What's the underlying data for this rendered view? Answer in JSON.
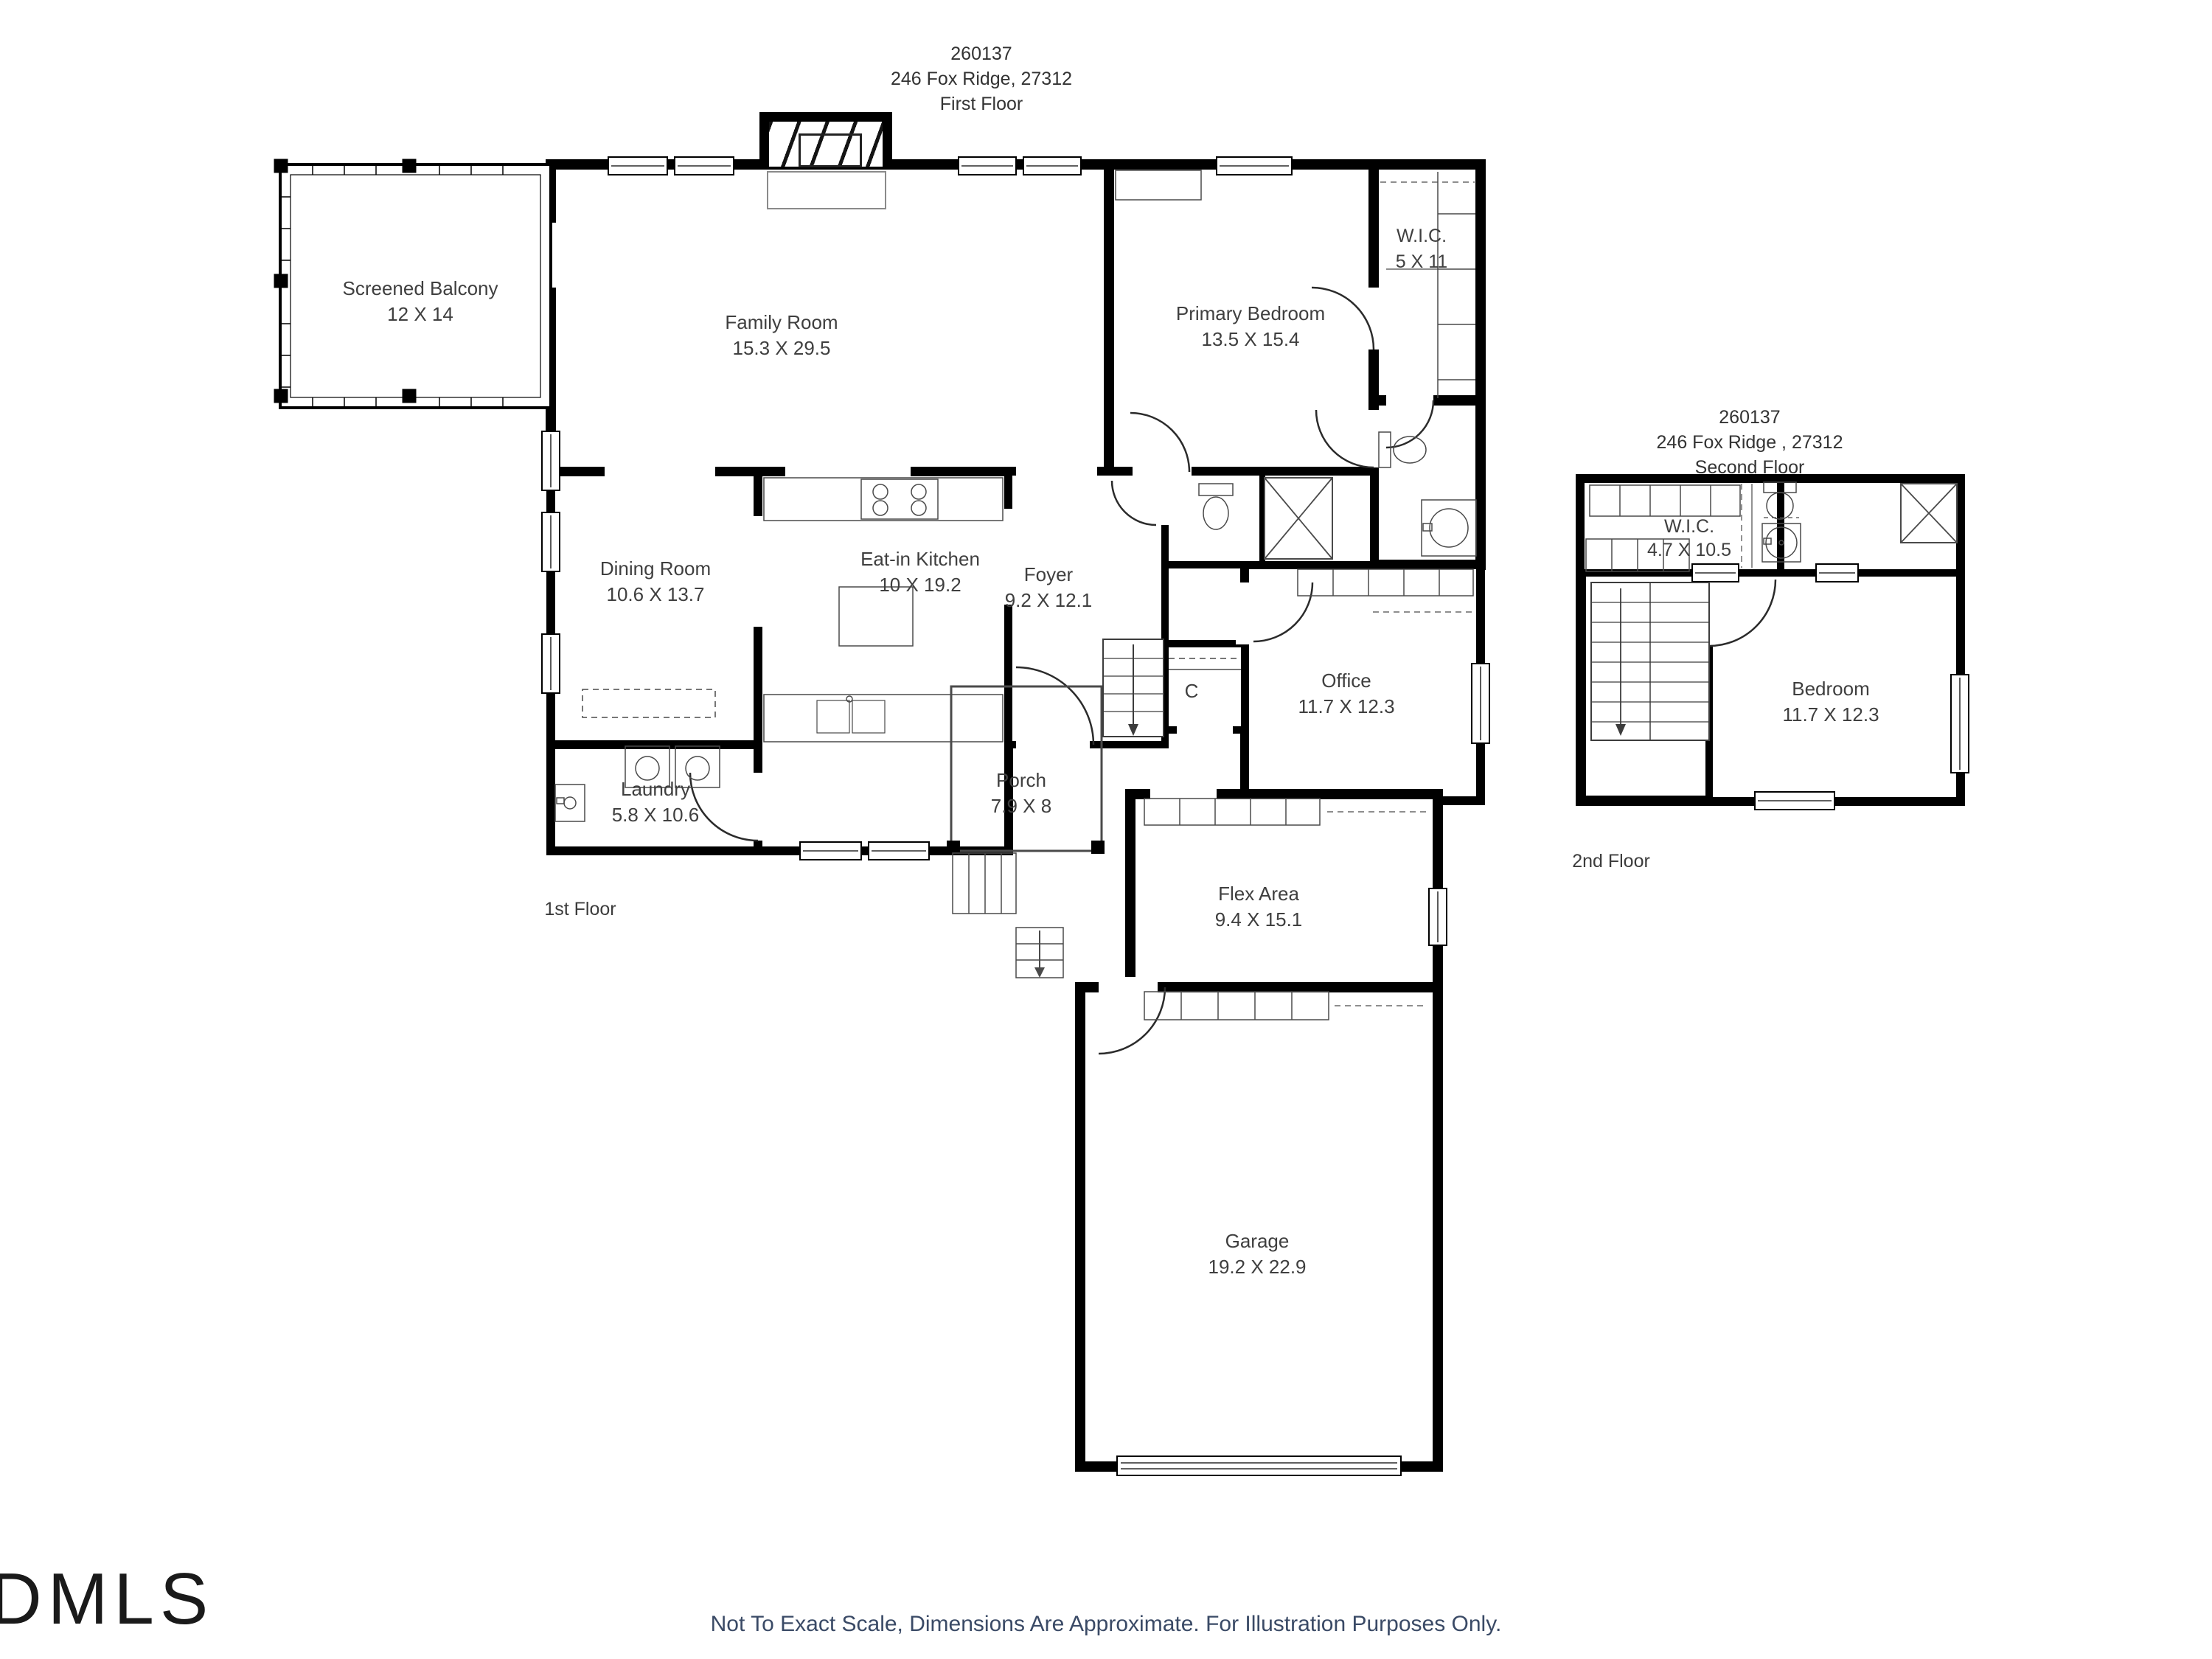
{
  "first_floor": {
    "header": {
      "mls_number": "260137",
      "address": "246 Fox Ridge, 27312",
      "floor_label": "First Floor"
    },
    "map_label": "1st Floor",
    "rooms": [
      {
        "label": "Screened Balcony",
        "dims": "12 X 14"
      },
      {
        "label": "Family Room",
        "dims": "15.3 X 29.5"
      },
      {
        "label": "Primary Bedroom",
        "dims": "13.5 X 15.4"
      },
      {
        "label": "W.I.C.",
        "dims": "5 X 11"
      },
      {
        "label": "Dining Room",
        "dims": "10.6 X 13.7"
      },
      {
        "label": "Eat-in Kitchen",
        "dims": "10 X 19.2"
      },
      {
        "label": "Foyer",
        "dims": "9.2 X 12.1"
      },
      {
        "label": "Office",
        "dims": "11.7 X 12.3"
      },
      {
        "label": "C",
        "dims": ""
      },
      {
        "label": "Laundry",
        "dims": "5.8 X 10.6"
      },
      {
        "label": "Porch",
        "dims": "7.9 X 8"
      },
      {
        "label": "Flex Area",
        "dims": "9.4 X 15.1"
      },
      {
        "label": "Garage",
        "dims": "19.2 X 22.9"
      }
    ]
  },
  "second_floor": {
    "header": {
      "mls_number": "260137",
      "address": "246 Fox Ridge , 27312",
      "floor_label": "Second Floor"
    },
    "map_label": "2nd Floor",
    "rooms": [
      {
        "label": "W.I.C.",
        "dims": "4.7 X 10.5"
      },
      {
        "label": "Bedroom",
        "dims": "11.7 X 12.3"
      }
    ]
  },
  "footer": {
    "disclaimer": "Not To Exact Scale, Dimensions Are Approximate. For Illustration Purposes Only."
  },
  "branding": {
    "logo_text": "DMLS"
  }
}
